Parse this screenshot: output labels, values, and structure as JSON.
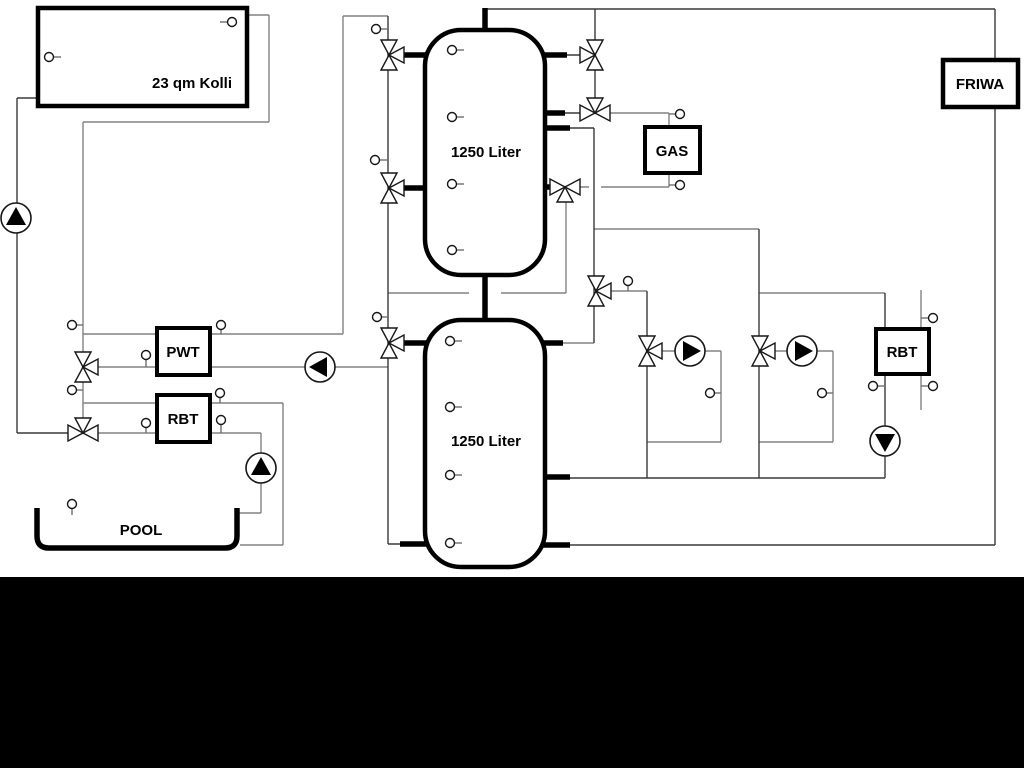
{
  "labels": {
    "collector": "23 qm Kolli",
    "tank_top": "1250 Liter",
    "tank_bottom": "1250 Liter",
    "pwt": "PWT",
    "rbt_left": "RBT",
    "rbt_right": "RBT",
    "gas": "GAS",
    "friwa": "FRIWA",
    "pool": "POOL"
  },
  "colors": {
    "pipe_primary": "#3a3a3a",
    "pipe_secondary": "#828282",
    "component_outline": "#000000",
    "background": "#ffffff",
    "footer_bar": "#000000"
  }
}
